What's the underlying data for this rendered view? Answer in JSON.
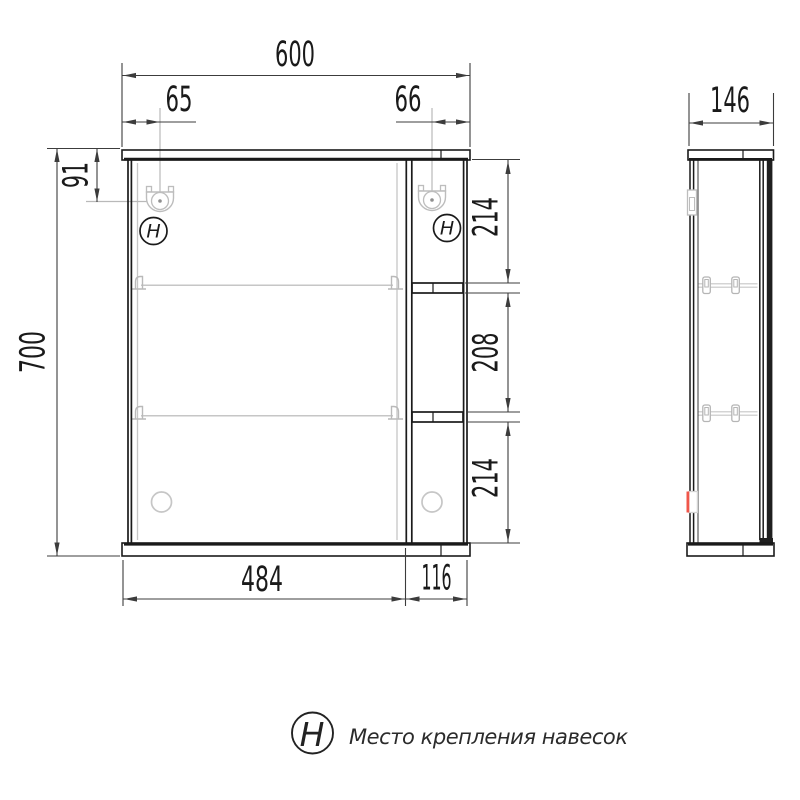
{
  "front_view": {
    "overall_width": "600",
    "hanger_offset_left": "65",
    "hanger_offset_right": "66",
    "hanger_offset_top": "91",
    "overall_height": "700",
    "right_section_top": "214",
    "right_section_middle": "208",
    "right_section_bottom": "214",
    "door_width": "484",
    "shelf_column_width": "116",
    "hanger_symbol": "H"
  },
  "side_view": {
    "depth": "146"
  },
  "legend": {
    "symbol": "H",
    "label": "Место крепления навесок"
  },
  "colors": {
    "outline": "#1a1a1a",
    "dimension": "#3c3c3c",
    "auxiliary": "#c6c6c6",
    "accent_red": "#f0564a",
    "background": "#ffffff"
  }
}
